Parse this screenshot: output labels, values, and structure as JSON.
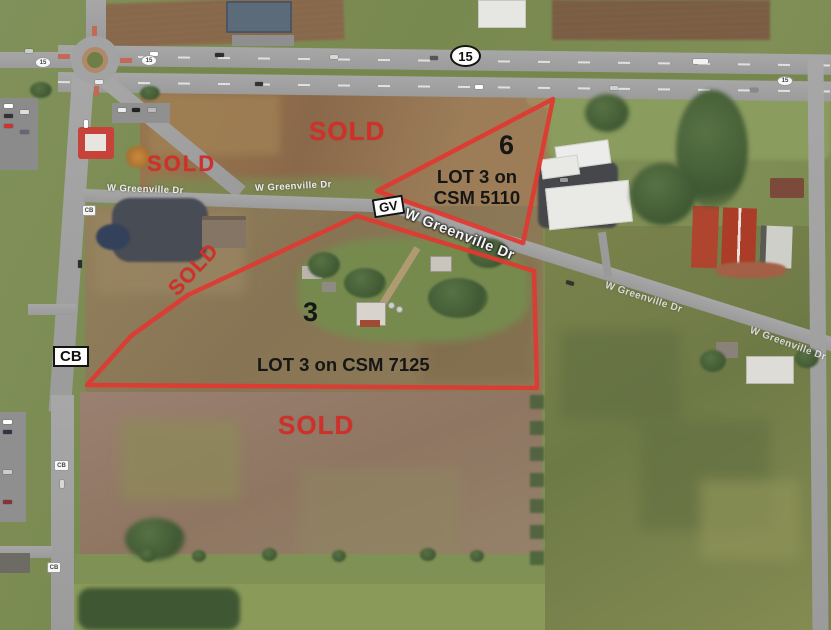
{
  "annotations": {
    "sold_labels": [
      "SOLD",
      "SOLD",
      "SOLD",
      "SOLD"
    ],
    "parcel_6": {
      "number": "6",
      "csm_line_1": "LOT 3 on",
      "csm_line_2": "CSM 5110"
    },
    "parcel_3": {
      "number": "3",
      "csm_label": "LOT 3 on CSM 7125"
    }
  },
  "shields": {
    "state_highway": "15",
    "greenville_route": "GV",
    "county_road": "CB"
  },
  "roads": {
    "greenville_name": "W Greenville Dr"
  },
  "colors": {
    "annotation_red": "#d0302a",
    "outline_red": "#de3a31",
    "label_black": "#161616"
  }
}
